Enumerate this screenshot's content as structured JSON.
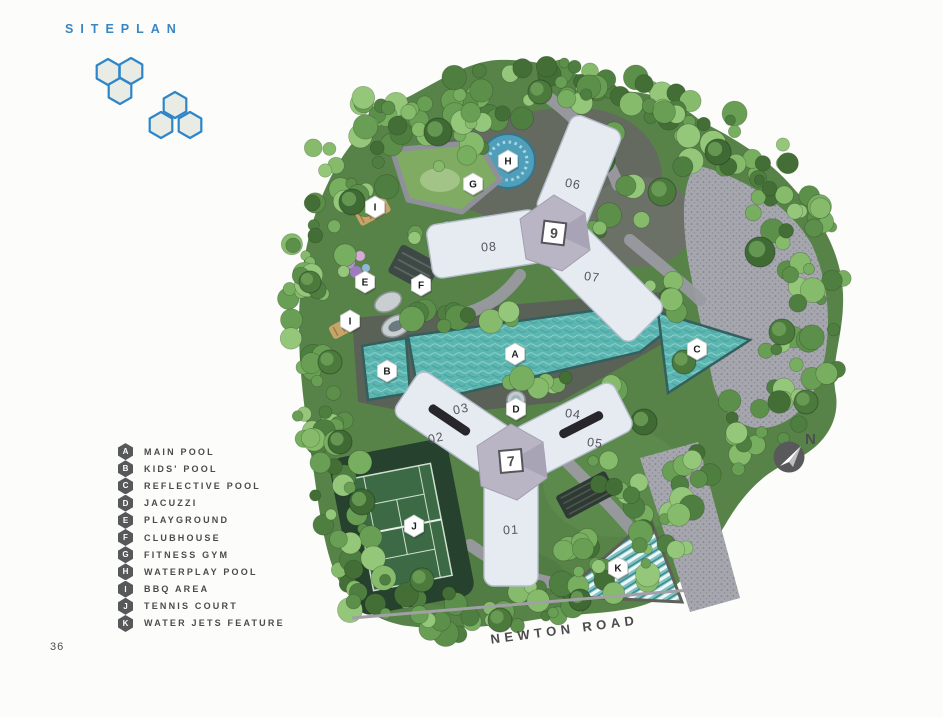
{
  "page": {
    "title": "SITEPLAN",
    "page_number": "36",
    "road_label": "NEWTON ROAD",
    "compass_label": "N"
  },
  "colors": {
    "title_blue": "#3a86c2",
    "logo_blue": "#2e86c8",
    "pool_teal": "#5bb5b0",
    "building_fill": "#e6ebf2",
    "hub_gray": "#b9b5c5",
    "legend_badge_gray": "#57585a",
    "canopy_green": "#689d53"
  },
  "legend": {
    "items": [
      {
        "id": "A",
        "label": "MAIN POOL"
      },
      {
        "id": "B",
        "label": "KIDS' POOL"
      },
      {
        "id": "C",
        "label": "REFLECTIVE POOL"
      },
      {
        "id": "D",
        "label": "JACUZZI"
      },
      {
        "id": "E",
        "label": "PLAYGROUND"
      },
      {
        "id": "F",
        "label": "CLUBHOUSE"
      },
      {
        "id": "G",
        "label": "FITNESS GYM"
      },
      {
        "id": "H",
        "label": "WATERPLAY POOL"
      },
      {
        "id": "I",
        "label": "BBQ AREA"
      },
      {
        "id": "J",
        "label": "TENNIS COURT"
      },
      {
        "id": "K",
        "label": "WATER JETS FEATURE"
      }
    ]
  },
  "map": {
    "markers": [
      {
        "id": "A",
        "x": 515,
        "y": 354
      },
      {
        "id": "B",
        "x": 387,
        "y": 371
      },
      {
        "id": "C",
        "x": 697,
        "y": 349
      },
      {
        "id": "D",
        "x": 516,
        "y": 409
      },
      {
        "id": "E",
        "x": 365,
        "y": 282
      },
      {
        "id": "F",
        "x": 421,
        "y": 285
      },
      {
        "id": "G",
        "x": 473,
        "y": 184
      },
      {
        "id": "H",
        "x": 508,
        "y": 161
      },
      {
        "id": "I",
        "x": 375,
        "y": 207
      },
      {
        "id": "I",
        "x": 350,
        "y": 321
      },
      {
        "id": "J",
        "x": 414,
        "y": 526
      },
      {
        "id": "K",
        "x": 618,
        "y": 568
      }
    ],
    "towers": [
      {
        "number": "9",
        "x": 554,
        "y": 233
      },
      {
        "number": "7",
        "x": 511,
        "y": 461
      }
    ],
    "units": [
      {
        "label": "06",
        "x": 573,
        "y": 184
      },
      {
        "label": "08",
        "x": 489,
        "y": 247
      },
      {
        "label": "07",
        "x": 592,
        "y": 277
      },
      {
        "label": "03",
        "x": 461,
        "y": 409
      },
      {
        "label": "02",
        "x": 436,
        "y": 438
      },
      {
        "label": "04",
        "x": 573,
        "y": 414
      },
      {
        "label": "05",
        "x": 595,
        "y": 443
      },
      {
        "label": "01",
        "x": 511,
        "y": 530
      }
    ]
  }
}
